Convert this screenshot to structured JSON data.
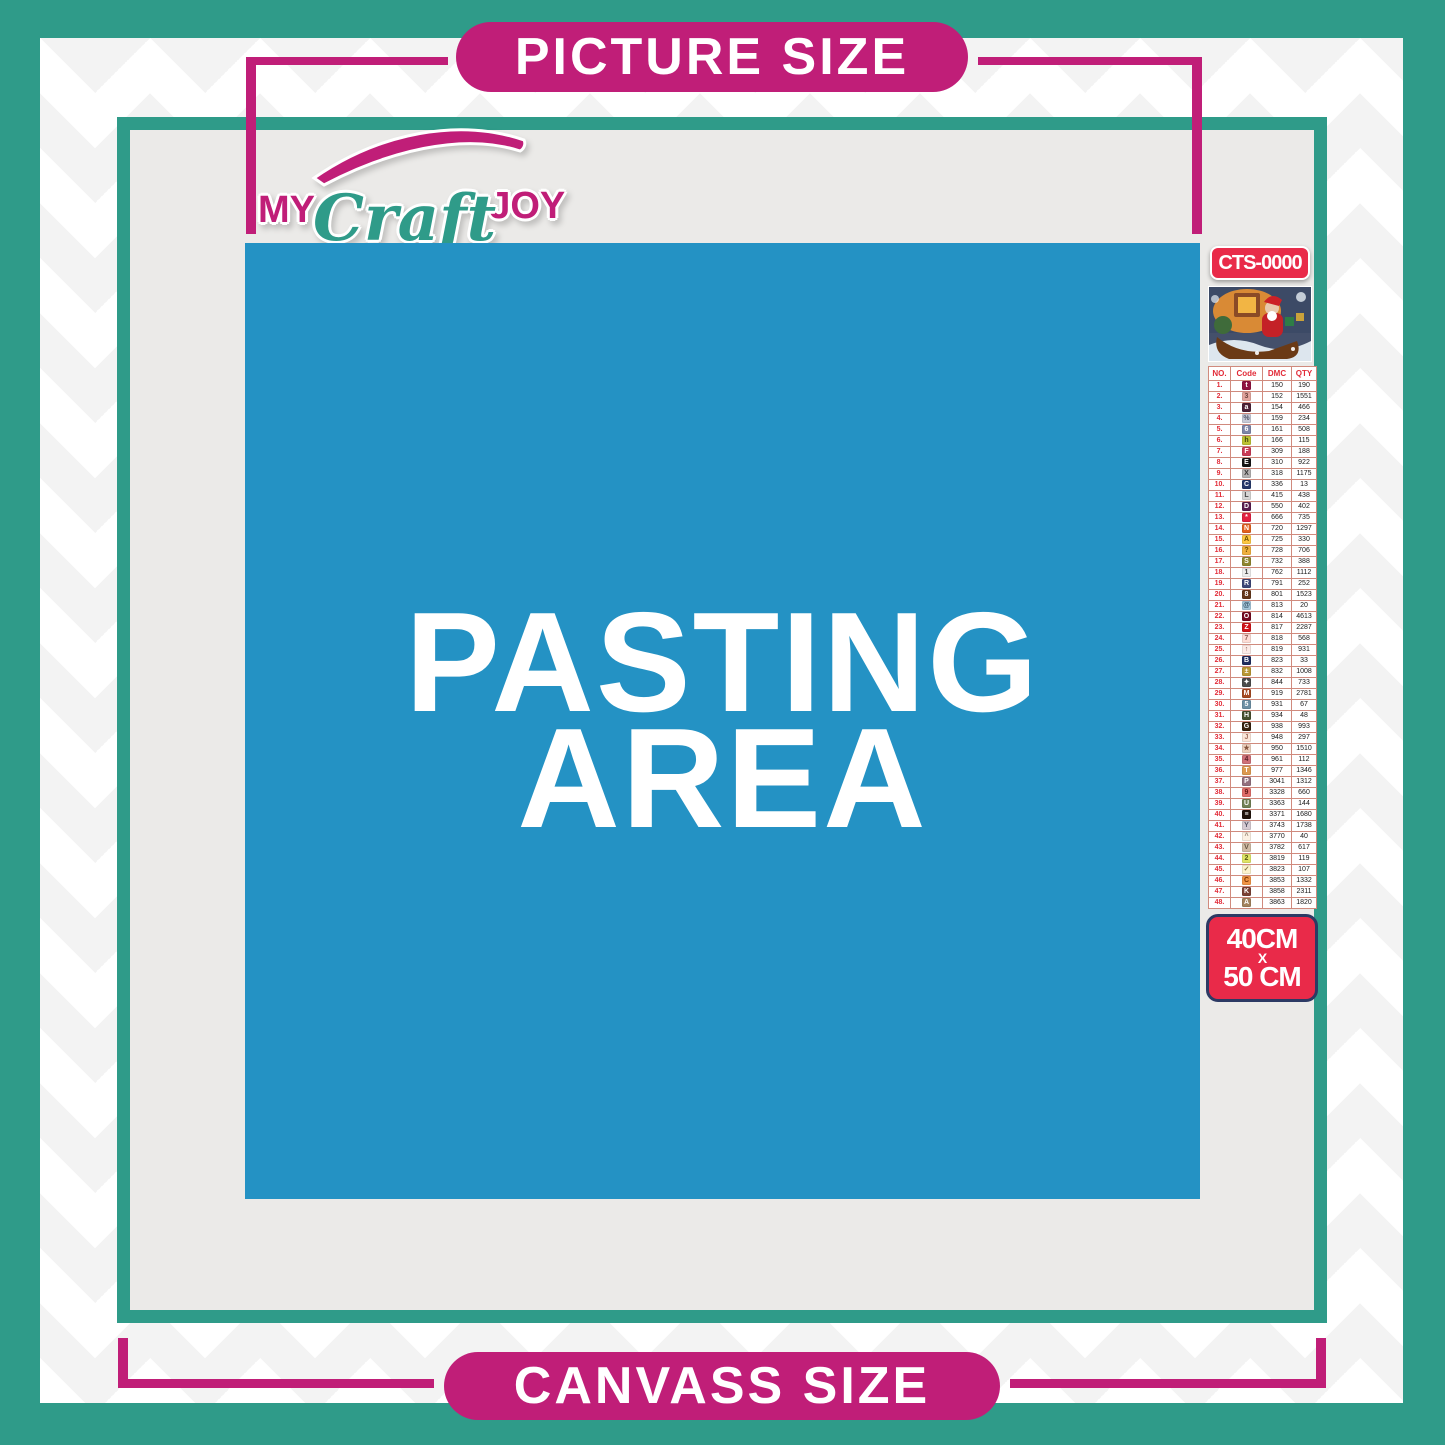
{
  "labels": {
    "picture_size": "PICTURE SIZE",
    "canvass_size": "CANVASS SIZE"
  },
  "logo": {
    "word1": "MY",
    "word2": "Craft",
    "word3": "JOY"
  },
  "pasting_area": {
    "line1": "PASTING",
    "line2": "AREA"
  },
  "product": {
    "sku": "CTS-0000",
    "preview": "christmas-santa-sleigh-painting-thumbnail",
    "size_label": {
      "width": "40CM",
      "separator": "X",
      "height": "50 CM"
    }
  },
  "legend": {
    "headers": [
      "NO.",
      "Code",
      "DMC",
      "QTY"
    ],
    "rows": [
      {
        "no": "1.",
        "sym": "t",
        "bg": "#8f1340",
        "fg": "#ffffff",
        "dmc": "150",
        "qty": "190"
      },
      {
        "no": "2.",
        "sym": "3",
        "bg": "#e3a59d",
        "fg": "#6d4540",
        "dmc": "152",
        "qty": "1551"
      },
      {
        "no": "3.",
        "sym": "a",
        "bg": "#4c2136",
        "fg": "#ffffff",
        "dmc": "154",
        "qty": "466"
      },
      {
        "no": "4.",
        "sym": "%",
        "bg": "#c7cad7",
        "fg": "#555a6e",
        "dmc": "159",
        "qty": "234"
      },
      {
        "no": "5.",
        "sym": "6",
        "bg": "#7d85a8",
        "fg": "#ffffff",
        "dmc": "161",
        "qty": "508"
      },
      {
        "no": "6.",
        "sym": "h",
        "bg": "#bcc233",
        "fg": "#44470f",
        "dmc": "166",
        "qty": "115"
      },
      {
        "no": "7.",
        "sym": "F",
        "bg": "#c93b56",
        "fg": "#ffffff",
        "dmc": "309",
        "qty": "188"
      },
      {
        "no": "8.",
        "sym": "E",
        "bg": "#141414",
        "fg": "#ffffff",
        "dmc": "310",
        "qty": "922"
      },
      {
        "no": "9.",
        "sym": "X",
        "bg": "#b3b1b1",
        "fg": "#333333",
        "dmc": "318",
        "qty": "1175"
      },
      {
        "no": "10.",
        "sym": "C",
        "bg": "#27396b",
        "fg": "#ffffff",
        "dmc": "336",
        "qty": "13"
      },
      {
        "no": "11.",
        "sym": "L",
        "bg": "#d6d5d4",
        "fg": "#444444",
        "dmc": "415",
        "qty": "438"
      },
      {
        "no": "12.",
        "sym": "D",
        "bg": "#5a1c4e",
        "fg": "#ffffff",
        "dmc": "550",
        "qty": "402"
      },
      {
        "no": "13.",
        "sym": "*",
        "bg": "#e32040",
        "fg": "#ffffff",
        "dmc": "666",
        "qty": "735"
      },
      {
        "no": "14.",
        "sym": "N",
        "bg": "#e2601f",
        "fg": "#ffffff",
        "dmc": "720",
        "qty": "1297"
      },
      {
        "no": "15.",
        "sym": "A",
        "bg": "#fdc742",
        "fg": "#6b4d00",
        "dmc": "725",
        "qty": "330"
      },
      {
        "no": "16.",
        "sym": "?",
        "bg": "#efaf3e",
        "fg": "#6b4d00",
        "dmc": "728",
        "qty": "706"
      },
      {
        "no": "17.",
        "sym": "S",
        "bg": "#8e852f",
        "fg": "#ffffff",
        "dmc": "732",
        "qty": "388"
      },
      {
        "no": "18.",
        "sym": "1",
        "bg": "#ededed",
        "fg": "#444444",
        "dmc": "762",
        "qty": "1112"
      },
      {
        "no": "19.",
        "sym": "R",
        "bg": "#3c4678",
        "fg": "#ffffff",
        "dmc": "791",
        "qty": "252"
      },
      {
        "no": "20.",
        "sym": "8",
        "bg": "#64381a",
        "fg": "#ffffff",
        "dmc": "801",
        "qty": "1523"
      },
      {
        "no": "21.",
        "sym": "@",
        "bg": "#a5c6da",
        "fg": "#2f4a5e",
        "dmc": "813",
        "qty": "20"
      },
      {
        "no": "22.",
        "sym": "O",
        "bg": "#750a20",
        "fg": "#ffffff",
        "dmc": "814",
        "qty": "4613"
      },
      {
        "no": "23.",
        "sym": "Z",
        "bg": "#d01419",
        "fg": "#ffffff",
        "dmc": "817",
        "qty": "2287"
      },
      {
        "no": "24.",
        "sym": "7",
        "bg": "#fcdcd5",
        "fg": "#96625a",
        "dmc": "818",
        "qty": "568"
      },
      {
        "no": "25.",
        "sym": "↑",
        "bg": "#fbeae6",
        "fg": "#8c6059",
        "dmc": "819",
        "qty": "931"
      },
      {
        "no": "26.",
        "sym": "B",
        "bg": "#1f2d5e",
        "fg": "#ffffff",
        "dmc": "823",
        "qty": "33"
      },
      {
        "no": "27.",
        "sym": "±",
        "bg": "#b99733",
        "fg": "#ffffff",
        "dmc": "832",
        "qty": "1008"
      },
      {
        "no": "28.",
        "sym": "✦",
        "bg": "#4b4b4b",
        "fg": "#ffffff",
        "dmc": "844",
        "qty": "733"
      },
      {
        "no": "29.",
        "sym": "M",
        "bg": "#a54a22",
        "fg": "#ffffff",
        "dmc": "919",
        "qty": "2781"
      },
      {
        "no": "30.",
        "sym": "5",
        "bg": "#6c8fa4",
        "fg": "#ffffff",
        "dmc": "931",
        "qty": "67"
      },
      {
        "no": "31.",
        "sym": "H",
        "bg": "#46502f",
        "fg": "#ffffff",
        "dmc": "934",
        "qty": "48"
      },
      {
        "no": "32.",
        "sym": "G",
        "bg": "#38220e",
        "fg": "#ffffff",
        "dmc": "938",
        "qty": "993"
      },
      {
        "no": "33.",
        "sym": "J",
        "bg": "#fbe5d8",
        "fg": "#a2705e",
        "dmc": "948",
        "qty": "297"
      },
      {
        "no": "34.",
        "sym": "★",
        "bg": "#edd0bd",
        "fg": "#84553e",
        "dmc": "950",
        "qty": "1510"
      },
      {
        "no": "35.",
        "sym": "4",
        "bg": "#cf7078",
        "fg": "#5c1f28",
        "dmc": "961",
        "qty": "112"
      },
      {
        "no": "36.",
        "sym": "T",
        "bg": "#dd9a50",
        "fg": "#ffffff",
        "dmc": "977",
        "qty": "1346"
      },
      {
        "no": "37.",
        "sym": "P",
        "bg": "#92707e",
        "fg": "#ffffff",
        "dmc": "3041",
        "qty": "1312"
      },
      {
        "no": "38.",
        "sym": "9",
        "bg": "#e06d6a",
        "fg": "#5e1717",
        "dmc": "3328",
        "qty": "660"
      },
      {
        "no": "39.",
        "sym": "U",
        "bg": "#718155",
        "fg": "#ffffff",
        "dmc": "3363",
        "qty": "144"
      },
      {
        "no": "40.",
        "sym": "≡",
        "bg": "#20130a",
        "fg": "#ffffff",
        "dmc": "3371",
        "qty": "1680"
      },
      {
        "no": "41.",
        "sym": "Y",
        "bg": "#d5cad2",
        "fg": "#555566",
        "dmc": "3743",
        "qty": "1738"
      },
      {
        "no": "42.",
        "sym": "^",
        "bg": "#fbf0e3",
        "fg": "#998877",
        "dmc": "3770",
        "qty": "40"
      },
      {
        "no": "43.",
        "sym": "V",
        "bg": "#d0bba4",
        "fg": "#665544",
        "dmc": "3782",
        "qty": "617"
      },
      {
        "no": "44.",
        "sym": "2",
        "bg": "#dfe465",
        "fg": "#565a15",
        "dmc": "3819",
        "qty": "119"
      },
      {
        "no": "45.",
        "sym": "✓",
        "bg": "#fcf3cd",
        "fg": "#887744",
        "dmc": "3823",
        "qty": "107"
      },
      {
        "no": "46.",
        "sym": "C",
        "bg": "#f09445",
        "fg": "#7b3503",
        "dmc": "3853",
        "qty": "1332"
      },
      {
        "no": "47.",
        "sym": "K",
        "bg": "#7b4134",
        "fg": "#ffffff",
        "dmc": "3858",
        "qty": "2311"
      },
      {
        "no": "48.",
        "sym": "A",
        "bg": "#a2825c",
        "fg": "#ffffff",
        "dmc": "3863",
        "qty": "1820"
      }
    ]
  },
  "colors": {
    "teal": "#2f9b89",
    "magenta": "#c01e78",
    "blue": "#2492c4",
    "red": "#e92a49",
    "navy": "#2c3a64",
    "inner_gray": "#ebeae8"
  }
}
